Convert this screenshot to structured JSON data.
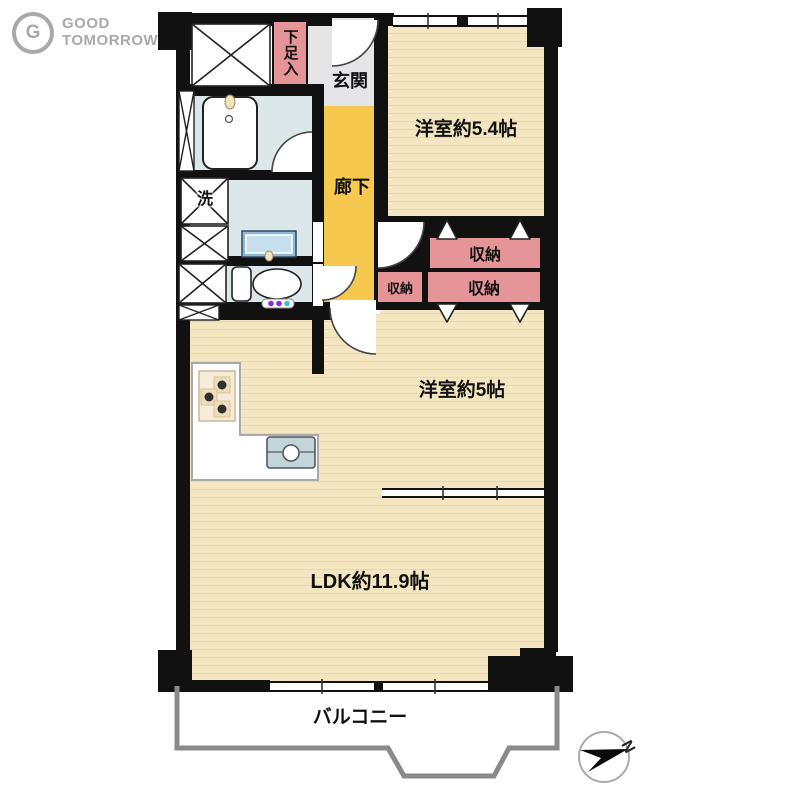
{
  "logo": {
    "icon_letter": "G",
    "line1": "GOOD",
    "line2": "TOMORROW"
  },
  "rooms": {
    "entrance": {
      "label": "玄関"
    },
    "hallway": {
      "label": "廊下"
    },
    "shoe_box": {
      "label": "下足入"
    },
    "laundry": {
      "label": "洗"
    },
    "bedroom1": {
      "label": "洋室約5.4帖"
    },
    "bedroom2": {
      "label": "洋室約5帖"
    },
    "ldk": {
      "label": "LDK約11.9帖"
    },
    "balcony": {
      "label": "バルコニー"
    },
    "storage_top": {
      "label": "収納"
    },
    "storage_small": {
      "label": "収納"
    },
    "storage_bottom": {
      "label": "収納"
    }
  },
  "compass": {
    "north": "N"
  },
  "colors": {
    "wall": "#111111",
    "wood_floor": "#f4e6c1",
    "wood_grain": "#ead8ab",
    "hallway_floor": "#f6c94e",
    "entrance_floor": "#e5e5e7",
    "wet_area_floor": "#dbe7e8",
    "storage_pink": "#e59598",
    "balcony_outline": "#8a8a8a",
    "logo_gray": "#a9a9a9"
  }
}
